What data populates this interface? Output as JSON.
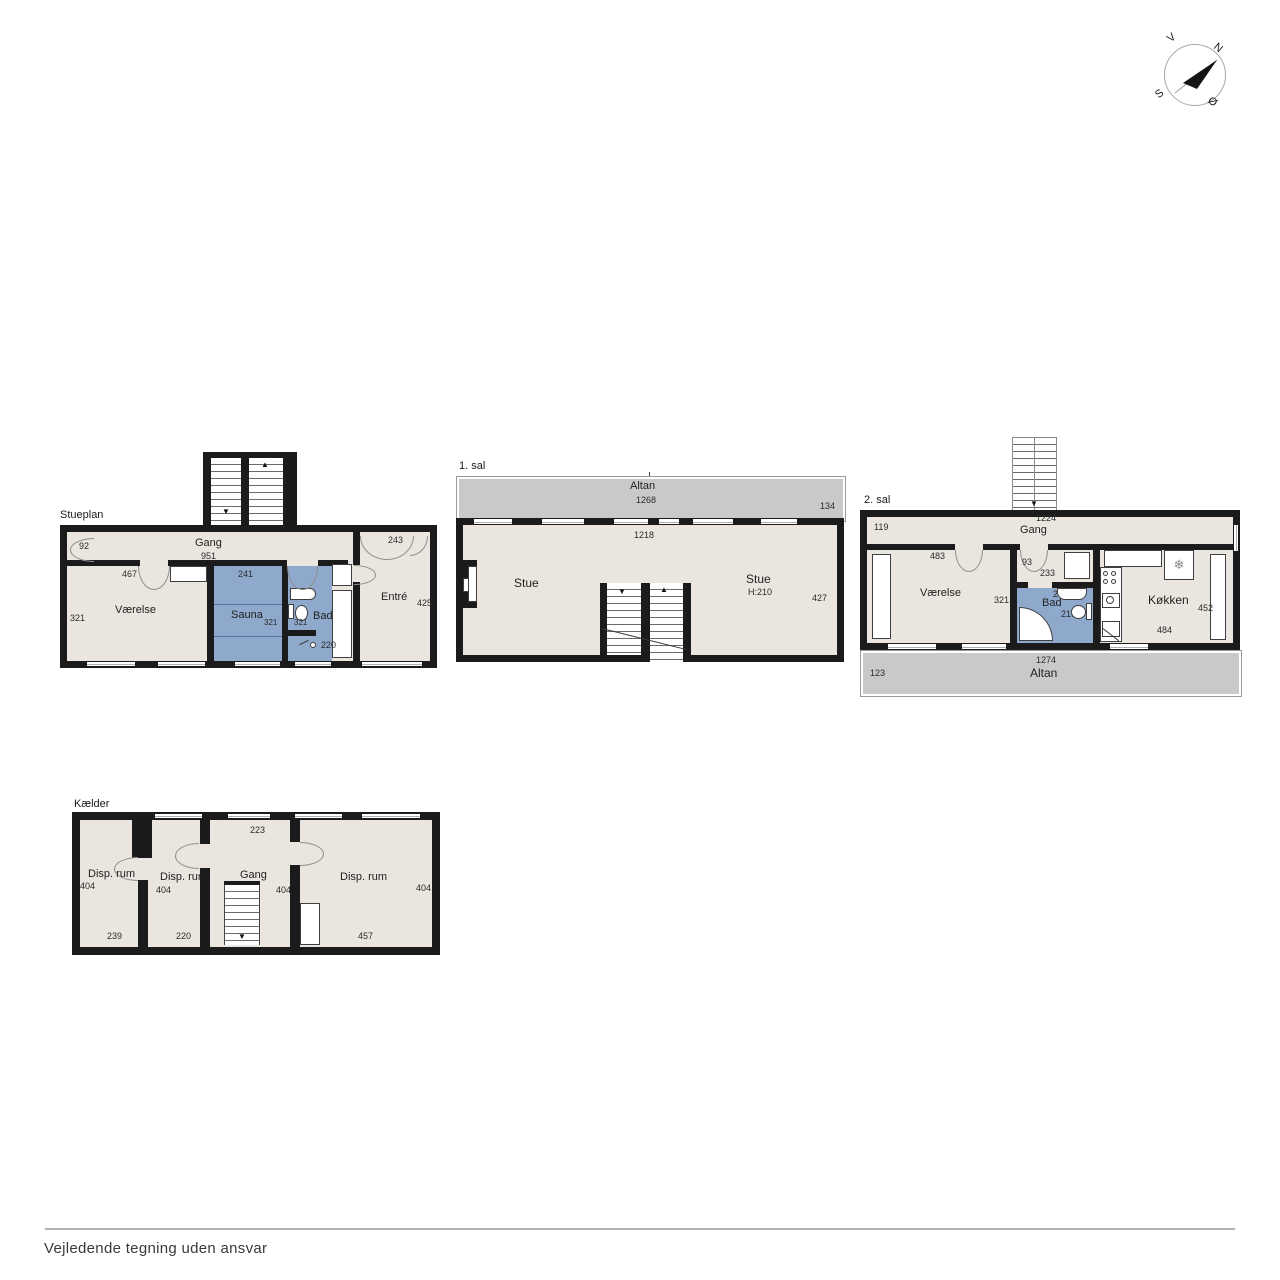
{
  "footer": {
    "disclaimer": "Vejledende tegning uden ansvar"
  },
  "compass": {
    "west": "V",
    "north": "N",
    "south": "S",
    "east": "Ø"
  },
  "colors": {
    "wall": "#1b1b1b",
    "floor": "#eae6df",
    "wet": "#8fa9cc",
    "balcony": "#c9c9c9"
  },
  "icons": {
    "freezer": "❄",
    "arrow_up": "▲",
    "arrow_down": "▼"
  },
  "stueplan": {
    "title": "Stueplan",
    "gang": {
      "label": "Gang",
      "width": "951",
      "door_left": "92",
      "door_right": "243"
    },
    "vaerelse": {
      "label": "Værelse",
      "top": "467",
      "left": "321"
    },
    "sauna": {
      "label": "Sauna",
      "top": "241",
      "width": "321"
    },
    "bad": {
      "label": "Bad",
      "width": "321",
      "drain": "220"
    },
    "entre": {
      "label": "Entré",
      "right": "425"
    }
  },
  "first_floor": {
    "title": "1. sal",
    "altan": {
      "label": "Altan",
      "width": "1268",
      "side": "134"
    },
    "stue": {
      "inner_width": "1218",
      "label_left": "Stue",
      "label_right": "Stue",
      "ceiling": "H:210",
      "right": "427"
    }
  },
  "second_floor": {
    "title": "2. sal",
    "gang": {
      "label": "Gang",
      "width": "1224",
      "left": "119"
    },
    "vaerelse": {
      "label": "Værelse",
      "top": "483",
      "right": "321"
    },
    "lobby": {
      "width": "93",
      "depth": "233"
    },
    "bad": {
      "label": "Bad",
      "top": "233",
      "height": "216"
    },
    "koekken": {
      "label": "Køkken",
      "right": "452",
      "bottom": "484"
    },
    "altan": {
      "label": "Altan",
      "width": "1274",
      "left": "123"
    }
  },
  "basement": {
    "title": "Kælder",
    "gang": {
      "label": "Gang",
      "top": "223",
      "height": "404"
    },
    "room1": {
      "label": "Disp. rum",
      "height": "404",
      "width": "239"
    },
    "room2": {
      "label": "Disp. rum",
      "height": "404",
      "width": "220"
    },
    "room3": {
      "label": "Disp. rum",
      "height": "404",
      "width": "457"
    }
  }
}
